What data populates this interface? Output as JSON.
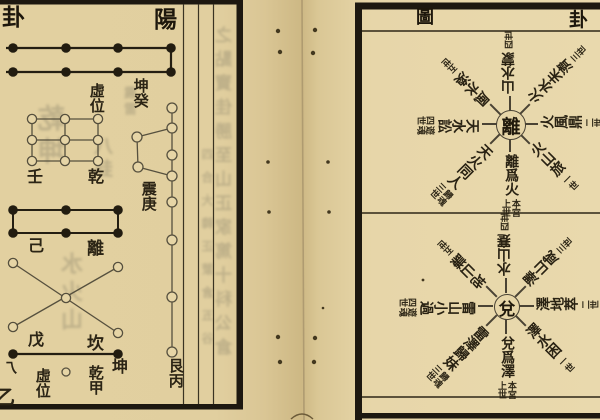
{
  "colors": {
    "paper_left": "#e2d0a0",
    "paper_right": "#e9d9ad",
    "gutter_shadow": "#cdb884",
    "ink_black": "#1d170c",
    "line_brown": "#56503e",
    "ghost_bleed": "#988f72"
  },
  "left_page": {
    "corner_title": "卦",
    "header": "陽",
    "bottom_corner": "乙",
    "labels": {
      "xu_wei_top": "虛位",
      "kun_gui": "坤癸",
      "ren": "壬",
      "qian": "乾",
      "zhen_geng": "震庚",
      "ji": "己",
      "li": "離",
      "wu": "戊",
      "kan": "坎",
      "hook": "乁",
      "xu_wei_bottom": "虛位",
      "qian_jia": "乾甲",
      "kun": "坤",
      "gen_bing": "艮丙"
    },
    "ghost_bleed": {
      "col_a": "之點寶佳勝至山正家篤十科公倉",
      "col_b": "四合大韓正蒙倉五谷",
      "patch_a": "乾坤",
      "patch_b": "八卦",
      "patch_c": "水火山",
      "patch_d": "震雷"
    }
  },
  "right_page": {
    "header_left": "圖",
    "header_right": "卦",
    "wheels": [
      {
        "center": "離",
        "spokes": [
          {
            "dir": "S",
            "text": "離爲火",
            "note": "本宮上世"
          },
          {
            "dir": "SE",
            "text": "火山旅",
            "note": "一世"
          },
          {
            "dir": "E",
            "text": "火風鼎",
            "note": "二世"
          },
          {
            "dir": "NE",
            "text": "火水未濟",
            "note": "三世"
          },
          {
            "dir": "N",
            "text": "山水蒙",
            "note": "四世"
          },
          {
            "dir": "NW",
            "text": "風水渙",
            "note": "五世"
          },
          {
            "dir": "W",
            "text": "天水訟",
            "note": "遊魂四世"
          },
          {
            "dir": "SW",
            "text": "天火同人",
            "note": "歸魂三世"
          }
        ]
      },
      {
        "center": "兌",
        "spokes": [
          {
            "dir": "S",
            "text": "兌爲澤",
            "note": "本宮上世"
          },
          {
            "dir": "SE",
            "text": "澤水困",
            "note": "一世"
          },
          {
            "dir": "E",
            "text": "澤地萃",
            "note": "二世"
          },
          {
            "dir": "NE",
            "text": "澤山咸",
            "note": "三世"
          },
          {
            "dir": "N",
            "text": "水山蹇",
            "note": "四世"
          },
          {
            "dir": "NW",
            "text": "地山謙",
            "note": "五世"
          },
          {
            "dir": "W",
            "text": "雷山小過",
            "note": "遊魂四世"
          },
          {
            "dir": "SW",
            "text": "雷澤歸妹",
            "note": "歸魂三世"
          }
        ]
      }
    ]
  }
}
